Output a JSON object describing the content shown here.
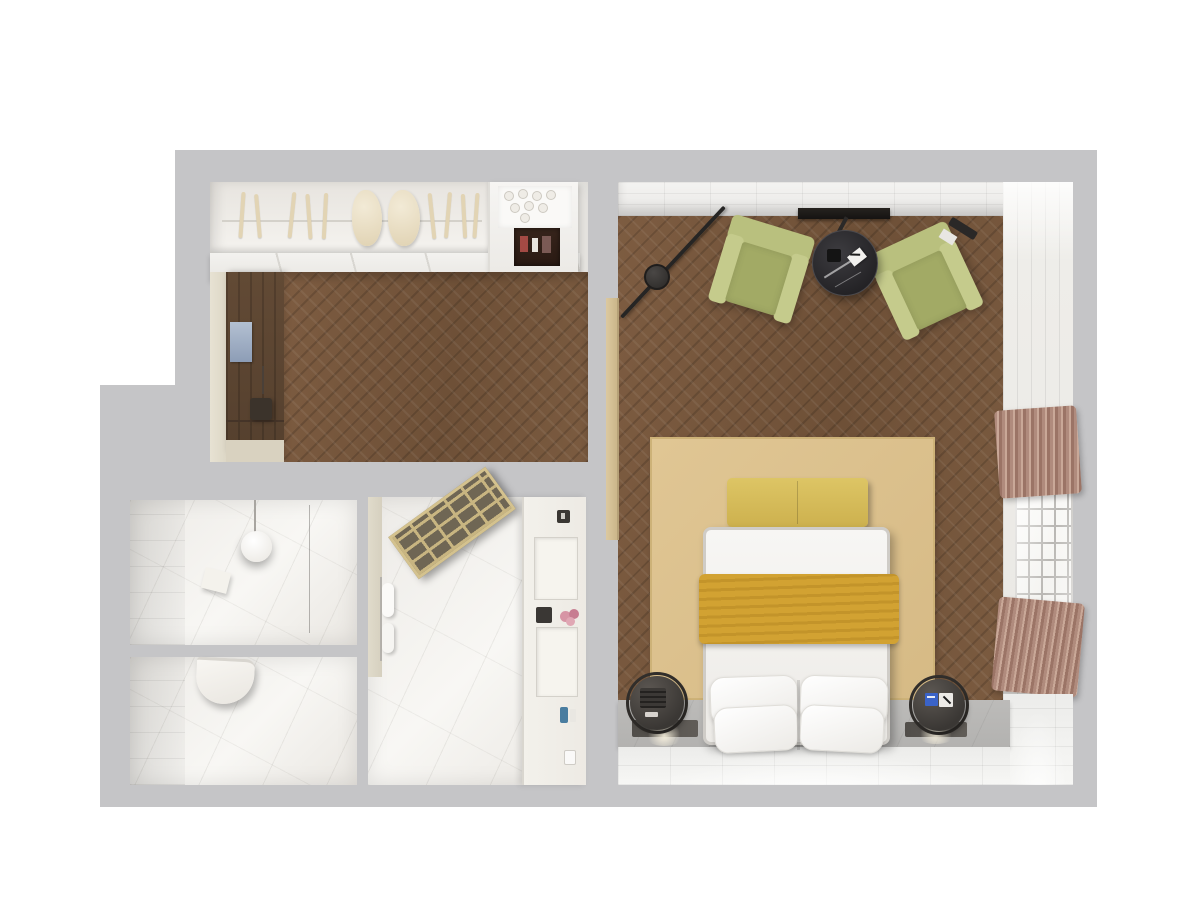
{
  "meta": {
    "type": "3d-floor-plan-render",
    "description": "Top-down 3D rendering of a hotel suite floor plan with entry hallway, bedroom, washbasin room, toilet room and shower room",
    "background_color": "#ffffff",
    "wall_color": "#c5c5c7"
  },
  "palette": {
    "wood_floor": "#765740",
    "marble": "#f0eeea",
    "white_tile": "#f2f2f0",
    "armchair_green": "#b6bd7c",
    "rug_tan": "#dcc18f",
    "throw_mustard": "#d0a02f",
    "bench_yellow": "#d9c263",
    "curtain_mauve": "#b08b7d",
    "table_black_marble": "#2e2d30",
    "dark_wood_panel": "#5f4833",
    "accent_blue_label": "#3a63c8"
  },
  "rooms": {
    "hallway": {
      "label": "Entry hallway with open wardrobe"
    },
    "bedroom": {
      "label": "Bedroom with seating area"
    },
    "bath_sink": {
      "label": "Washbasin room"
    },
    "bath_wc": {
      "label": "Toilet room"
    },
    "shower": {
      "label": "Shower room"
    }
  },
  "furniture": {
    "wardrobe": "Open wardrobe with hangers and clothes",
    "hanger_rod": "Wardrobe hanger rod",
    "coffee_station": "Minibar / coffee station with glasses",
    "wood_panel": "Dark wood wall panelling",
    "picture": "Wall picture",
    "valet": "Valet stand",
    "stool": "Dark stool",
    "door_leaf": "Open door leaf",
    "tv": "Wall-mounted TV",
    "arc_lamp": "Black arc floor lamp",
    "armchair_left": "Green armchair (left)",
    "armchair_right": "Green armchair (right)",
    "coffee_table": "Round black marble coffee table",
    "table_card": "White notepad with pen",
    "table_item": "Dark cup",
    "rug": "Tan area rug",
    "bench": "Yellow bench at foot of bed",
    "bed": "Double bed with white linen",
    "throw": "Mustard throw blanket",
    "pillow": "Pillow",
    "nightstand_left": "Spherical nightstand with speaker",
    "nightstand_right": "Spherical nightstand with notepad",
    "floor_vent": "Recessed floor light strip",
    "window": "Lattice window",
    "curtain_top": "Mauve curtain (north bunch)",
    "curtain_bottom": "Mauve curtain (south bunch)",
    "washbasin": "Round white washbasin",
    "soap_tray": "Soap tray",
    "glass_divider": "Glass divider",
    "toilet": "Wall-hung toilet",
    "shower_screen": "Brass-framed shower screen",
    "towel_rail": "Towel rail with towels",
    "vanity": "Shower room vanity wall",
    "niche": "Recessed shelf niche",
    "control": "Wall control panel",
    "flowers": "Pink flowers",
    "toiletries": "Toiletries",
    "glass_cup": "Glass"
  }
}
